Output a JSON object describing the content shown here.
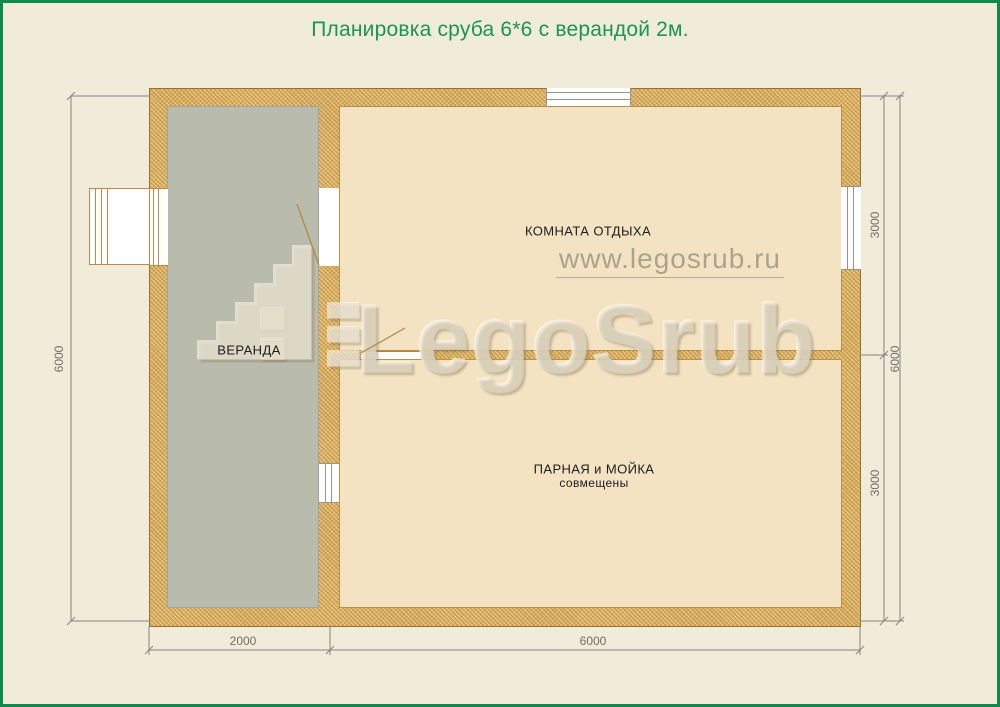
{
  "title": "Планировка сруба 6*6 с верандой 2м.",
  "rooms": {
    "veranda": {
      "label": "ВЕРАНДА"
    },
    "rest": {
      "label": "КОМНАТА ОТДЫХА"
    },
    "steam": {
      "label": "ПАРНАЯ и МОЙКА",
      "sublabel": "совмещены"
    }
  },
  "dimensions": {
    "left_total": "6000",
    "right_top": "3000",
    "right_total": "6000",
    "right_bottom": "3000",
    "bottom_veranda": "2000",
    "bottom_house": "6000"
  },
  "watermark": {
    "url": "www.legosrub.ru",
    "brand": "LegoSrub"
  },
  "colors": {
    "page_background": "#f1ecda",
    "page_border_green": "#0f8a4e",
    "title_green": "#1b9457",
    "wall_fill": "#d3a85a",
    "wall_outline": "#9c6f28",
    "veranda_floor": "#b9bcac",
    "room_floor": "#f3e3c2",
    "dimension_line": "#85847c",
    "door_swing": "#b5833d"
  }
}
